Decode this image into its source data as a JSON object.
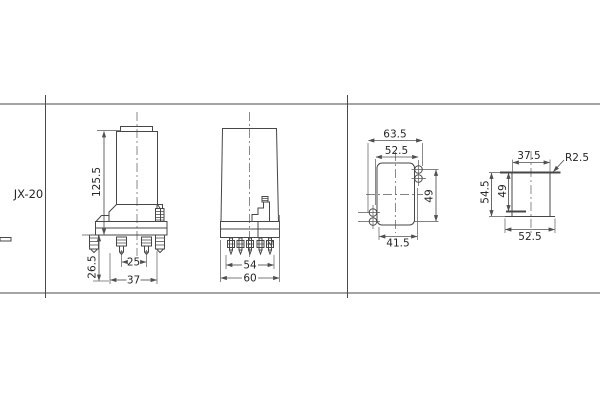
{
  "sheet": {
    "row_label": "JX-20"
  },
  "front_view": {
    "height": "125.5",
    "terminal_length": "26.5",
    "pin_spacing": "25",
    "base_span": "37"
  },
  "side_view": {
    "pin_row_span": "54",
    "overall_width": "60"
  },
  "panel_cutout": {
    "outer_width": "63.5",
    "upper_hole_span": "52.5",
    "vertical_hole_span": "49",
    "lower_hole_span": "41.5"
  },
  "flush_cutout": {
    "top_width": "37.5",
    "corner_radius": "R2.5",
    "outer_height": "54.5",
    "inner_height": "49",
    "bottom_width": "52.5"
  },
  "colors": {
    "line": "#474747",
    "dimension": "#4f4f4f",
    "text": "#262626",
    "background": "#ffffff"
  }
}
